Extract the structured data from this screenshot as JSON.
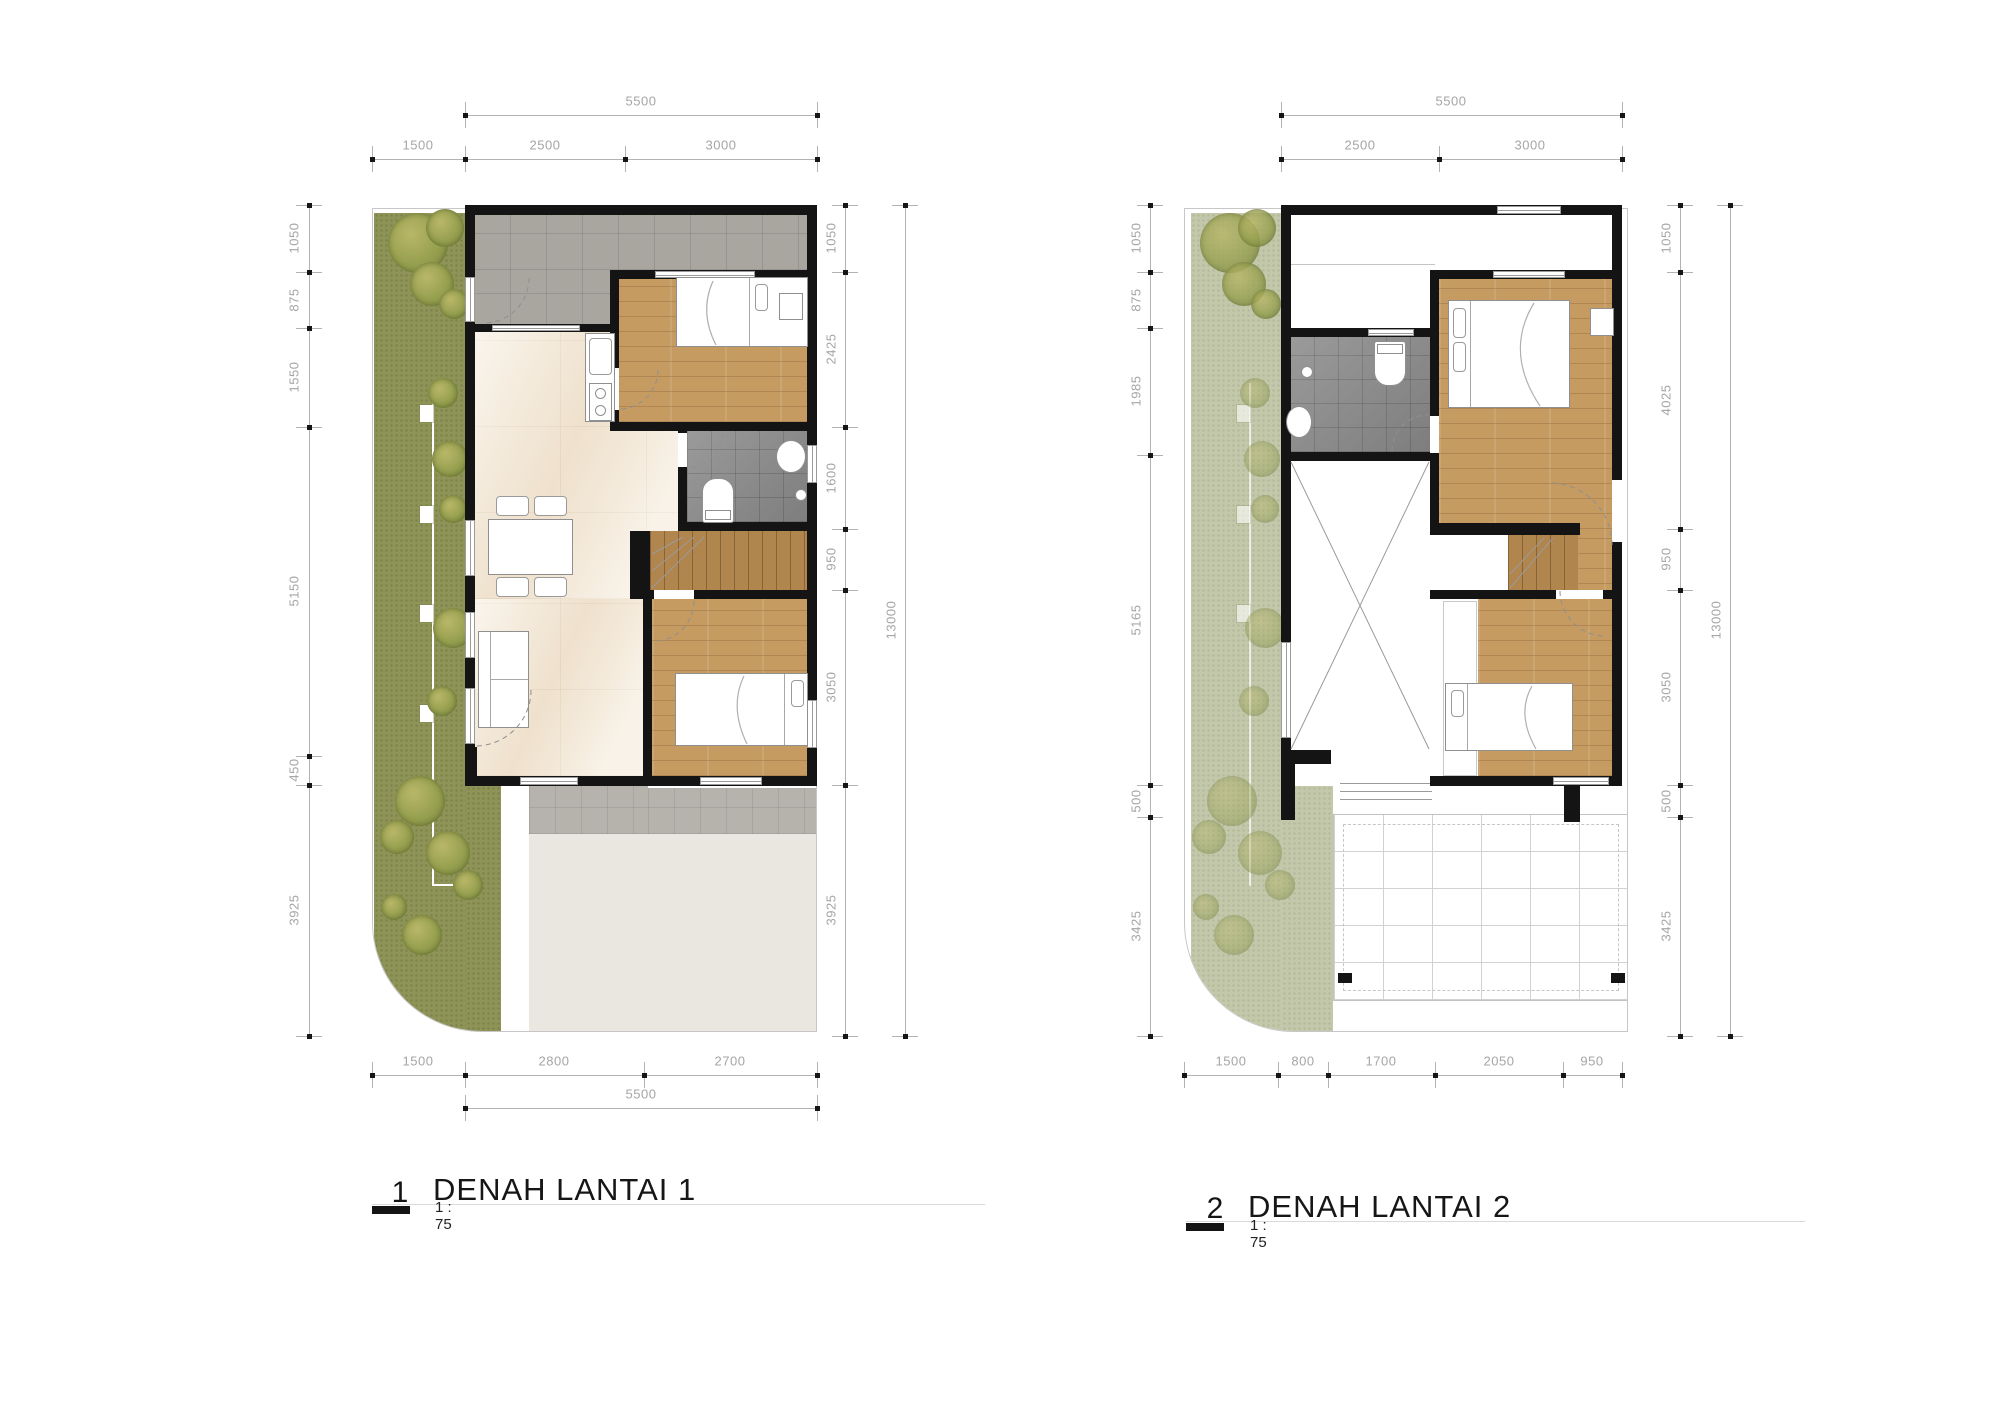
{
  "palette": {
    "wall": "#141414",
    "grass": "#8e9457",
    "grass-faded": "#c3c8ab",
    "wood": "#c59b62",
    "wood-stairs": "#b0854e",
    "marble": "#f4e9d8",
    "tile-carport": "#a9a6a0",
    "tile-terrace": "#b6b3ad",
    "tile-bath": "#8f8f8f",
    "driveway": "#eae7e0",
    "dim-text": "#a5a5a5",
    "dim-line": "#b3b3b3",
    "tree": "#97a050"
  },
  "plan1": {
    "label": "1",
    "title": "DENAH LANTAI 1",
    "scale": "1 : 75",
    "dims": {
      "top_overall": "5500",
      "top": [
        "1500",
        "2500",
        "3000"
      ],
      "left": [
        "1050",
        "875",
        "1550",
        "5150",
        "450",
        "3925"
      ],
      "right": [
        "1050",
        "2425",
        "1600",
        "950",
        "3050",
        "3925"
      ],
      "right_overall": "13000",
      "bottom": [
        "1500",
        "2800",
        "2700"
      ],
      "bottom_overall": "5500"
    }
  },
  "plan2": {
    "label": "2",
    "title": "DENAH LANTAI 2",
    "scale": "1 : 75",
    "dims": {
      "top_overall": "5500",
      "top": [
        "2500",
        "3000"
      ],
      "left": [
        "1050",
        "875",
        "1985",
        "5165",
        "500",
        "3425"
      ],
      "right": [
        "1050",
        "4025",
        "950",
        "3050",
        "500",
        "3425"
      ],
      "right_overall": "13000",
      "bottom": [
        "1500",
        "800",
        "1700",
        "2050",
        "950"
      ]
    }
  }
}
